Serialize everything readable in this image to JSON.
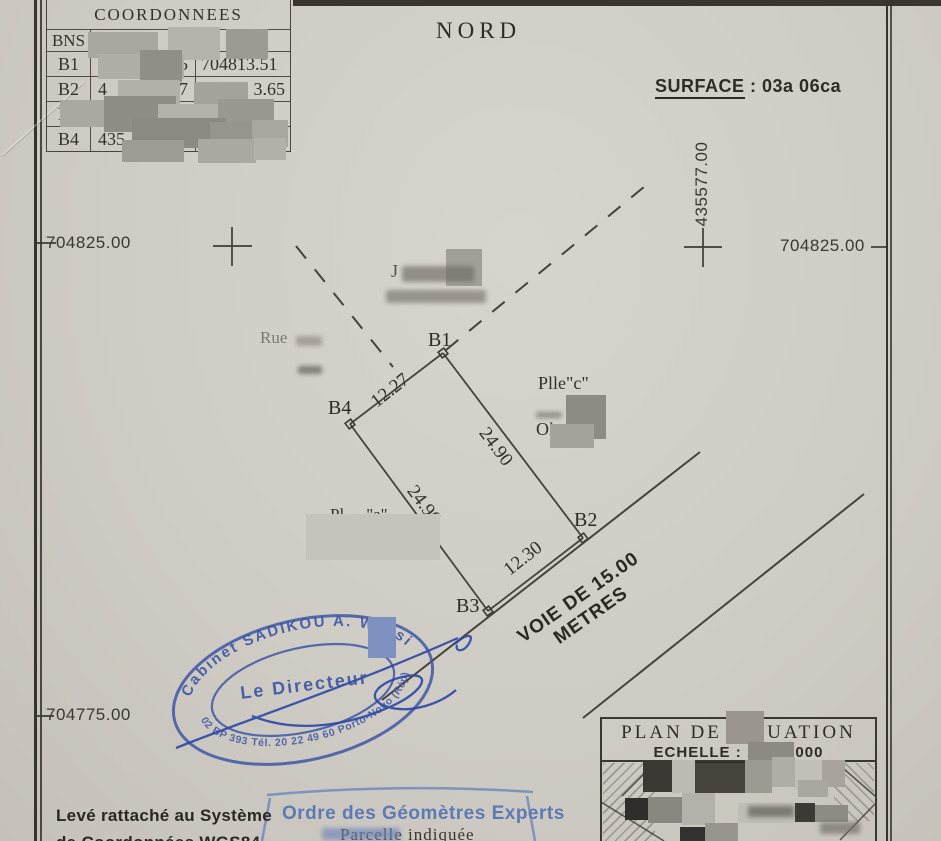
{
  "colors": {
    "paper": "#cfccc5",
    "ink": "#34312b",
    "stamp_blue": "#3c54a2",
    "ordre_blue": "#5d7ab5"
  },
  "coord_table": {
    "title": "COORDONNEES",
    "point_col": "BNS",
    "x_col": "X",
    "rows": [
      {
        "id": "B1",
        "x1": "",
        "x2": ".65",
        "y1": "704813.51",
        "y2": ""
      },
      {
        "id": "B2",
        "x1": "4",
        "x2": "64.67",
        "y1": "704",
        "y2": "3.65"
      },
      {
        "id": "B3",
        "x1": "43",
        "x2": "",
        "y1": "",
        "y2": ""
      },
      {
        "id": "B4",
        "x1": "435",
        "x2": "",
        "y1": "",
        "y2": "4805.88"
      }
    ]
  },
  "header": {
    "north": "NORD",
    "surface_label": "SURFACE",
    "surface_value": ":  03a 06ca"
  },
  "grid": {
    "vertical_coord": "435577.00",
    "left_top": "704825.00",
    "right_top": "704825.00",
    "left_bottom": "704775.00"
  },
  "parcel": {
    "b1": "B1",
    "b2": "B2",
    "b3": "B3",
    "b4": "B4",
    "dim_b4b1": "12.27",
    "dim_b1b2": "24.90",
    "dim_b4b3": "24.90",
    "dim_b3b2": "12.30",
    "plle_c": "Plle\"c\"",
    "olo": "Olo",
    "plle_a_left": "Pl",
    "plle_a_right": "\"a\"",
    "rue": "Rue",
    "j": "J"
  },
  "road": {
    "label": "VOIE DE 15.00 METRES"
  },
  "stamp": {
    "arc_top": "Cabinet SADIKOU A. Wassi",
    "center": "Le  Directeur",
    "arc_bottom": "02 BP 393 Tél. 20 22 49 60 Porto-Novo (Rép)"
  },
  "plan_box": {
    "title": "PLAN  DE  SITUATION",
    "echelle_left": "ECHELLE : 1/",
    "echelle_right": "000"
  },
  "footer": {
    "leve_line1": "Levé rattaché au Système",
    "leve_line2": "de Coordonnées WGS84",
    "ordre": "Ordre des Géomètres Experts",
    "parcelle": "Parcelle  indiquée"
  },
  "redactions": [
    {
      "x": 88,
      "y": 32,
      "w": 70,
      "h": 26,
      "c": "#a9a69f"
    },
    {
      "x": 168,
      "y": 27,
      "w": 52,
      "h": 33,
      "c": "#b6b3ac"
    },
    {
      "x": 226,
      "y": 29,
      "w": 42,
      "h": 30,
      "c": "#9d9a93"
    },
    {
      "x": 98,
      "y": 54,
      "w": 86,
      "h": 25,
      "c": "#b1aea7"
    },
    {
      "x": 140,
      "y": 50,
      "w": 42,
      "h": 32,
      "c": "#918e88"
    },
    {
      "x": 118,
      "y": 80,
      "w": 62,
      "h": 25,
      "c": "#b3b0a9"
    },
    {
      "x": 194,
      "y": 82,
      "w": 54,
      "h": 25,
      "c": "#a6a39c"
    },
    {
      "x": 60,
      "y": 100,
      "w": 48,
      "h": 27,
      "c": "#aba8a1"
    },
    {
      "x": 104,
      "y": 96,
      "w": 72,
      "h": 36,
      "c": "#908d87"
    },
    {
      "x": 158,
      "y": 104,
      "w": 78,
      "h": 26,
      "c": "#b5b2ab"
    },
    {
      "x": 218,
      "y": 99,
      "w": 56,
      "h": 31,
      "c": "#9b9891"
    },
    {
      "x": 132,
      "y": 118,
      "w": 94,
      "h": 30,
      "c": "#8c8983"
    },
    {
      "x": 210,
      "y": 122,
      "w": 66,
      "h": 28,
      "c": "#97948d"
    },
    {
      "x": 252,
      "y": 120,
      "w": 36,
      "h": 27,
      "c": "#a9a6a0"
    },
    {
      "x": 122,
      "y": 140,
      "w": 62,
      "h": 22,
      "c": "#9e9b94"
    },
    {
      "x": 198,
      "y": 139,
      "w": 58,
      "h": 24,
      "c": "#aba8a1"
    },
    {
      "x": 254,
      "y": 138,
      "w": 32,
      "h": 22,
      "c": "#b3b0a9"
    },
    {
      "x": 446,
      "y": 249,
      "w": 36,
      "h": 37,
      "c": "#a29f98"
    },
    {
      "x": 402,
      "y": 266,
      "w": 72,
      "h": 16,
      "c": "#6f6b64",
      "blur": true
    },
    {
      "x": 386,
      "y": 290,
      "w": 100,
      "h": 13,
      "c": "#77736c",
      "blur": true
    },
    {
      "x": 296,
      "y": 336,
      "w": 26,
      "h": 10,
      "c": "#8d8981",
      "blur": true
    },
    {
      "x": 298,
      "y": 366,
      "w": 24,
      "h": 8,
      "c": "#57544e",
      "blur": true
    },
    {
      "x": 566,
      "y": 395,
      "w": 40,
      "h": 44,
      "c": "#8e8b84"
    },
    {
      "x": 550,
      "y": 424,
      "w": 44,
      "h": 24,
      "c": "#a6a39d"
    },
    {
      "x": 536,
      "y": 412,
      "w": 26,
      "h": 6,
      "c": "#6f6b64",
      "blur": true
    },
    {
      "x": 306,
      "y": 514,
      "w": 134,
      "h": 46,
      "c": "#c6c3bc"
    },
    {
      "x": 368,
      "y": 617,
      "w": 28,
      "h": 41,
      "c": "#7e90c0"
    },
    {
      "x": 726,
      "y": 711,
      "w": 38,
      "h": 33,
      "c": "#9a968f"
    },
    {
      "x": 748,
      "y": 742,
      "w": 46,
      "h": 20,
      "c": "#8d8a83"
    },
    {
      "x": 322,
      "y": 828,
      "w": 78,
      "h": 12,
      "c": "#6d83b8",
      "blur": true
    },
    {
      "x": 643,
      "y": 762,
      "w": 29,
      "h": 30,
      "c": "#3b3833"
    },
    {
      "x": 672,
      "y": 760,
      "w": 23,
      "h": 33,
      "c": "#bdbab3"
    },
    {
      "x": 695,
      "y": 763,
      "w": 50,
      "h": 30,
      "c": "#46433d"
    },
    {
      "x": 745,
      "y": 760,
      "w": 27,
      "h": 33,
      "c": "#9d9a93"
    },
    {
      "x": 772,
      "y": 757,
      "w": 23,
      "h": 30,
      "c": "#b0ada6"
    },
    {
      "x": 795,
      "y": 760,
      "w": 27,
      "h": 30,
      "c": "#c2bfb8"
    },
    {
      "x": 822,
      "y": 760,
      "w": 23,
      "h": 27,
      "c": "#a8a49d"
    },
    {
      "x": 625,
      "y": 798,
      "w": 23,
      "h": 22,
      "c": "#302e2a"
    },
    {
      "x": 648,
      "y": 797,
      "w": 34,
      "h": 26,
      "c": "#8a8781"
    },
    {
      "x": 682,
      "y": 793,
      "w": 33,
      "h": 32,
      "c": "#b4b1aa"
    },
    {
      "x": 680,
      "y": 827,
      "w": 25,
      "h": 14,
      "c": "#33312d"
    },
    {
      "x": 705,
      "y": 823,
      "w": 33,
      "h": 18,
      "c": "#98958e"
    },
    {
      "x": 738,
      "y": 803,
      "w": 57,
      "h": 20,
      "c": "#c0bdb6"
    },
    {
      "x": 795,
      "y": 803,
      "w": 20,
      "h": 19,
      "c": "#3d3a35"
    },
    {
      "x": 815,
      "y": 805,
      "w": 33,
      "h": 17,
      "c": "#8e8b85"
    },
    {
      "x": 798,
      "y": 780,
      "w": 30,
      "h": 17,
      "c": "#aaa7a0"
    },
    {
      "x": 748,
      "y": 806,
      "w": 46,
      "h": 11,
      "c": "#595650",
      "blur": true
    },
    {
      "x": 820,
      "y": 822,
      "w": 40,
      "h": 12,
      "c": "#706c66",
      "blur": true
    }
  ]
}
